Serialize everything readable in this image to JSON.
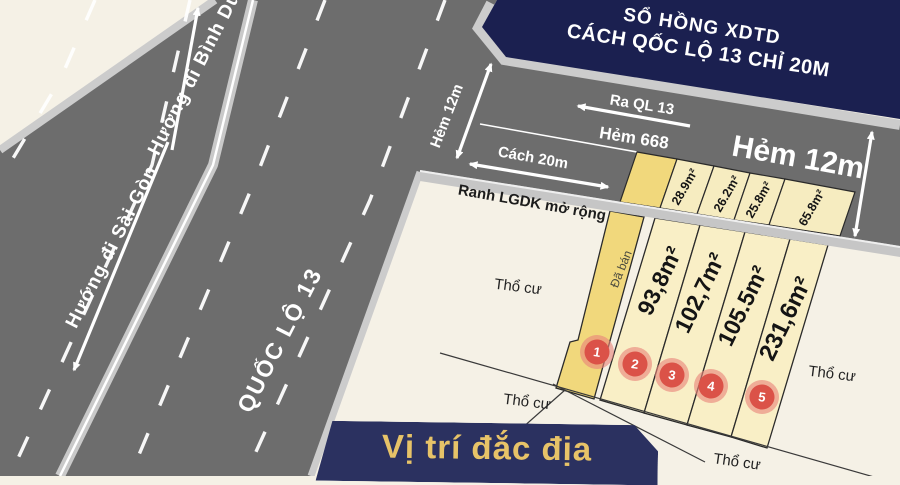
{
  "banner_top": {
    "line1": "SỔ HỒNG XDTD",
    "line2": "CÁCH QỐC LỘ 13 CHỈ 20M"
  },
  "banner_bottom": {
    "text": "Vị trí đắc địa"
  },
  "highway": {
    "name": "QUỐC LỘ 13",
    "dir_saigon": "Hướng đi Sài Gòn",
    "dir_binhduong": "Hướng đi Bình Dương"
  },
  "alley": {
    "name": "Hẻm 668",
    "exit_label": "Ra QL 13",
    "width_label": "Hẻm 12m",
    "distance_label": "Cách 20m",
    "boundary_label": "Ranh LGDK mở rộng"
  },
  "strips": [
    {
      "area": "28.9m²"
    },
    {
      "area": "26.2m²"
    },
    {
      "area": "25.8m²"
    },
    {
      "area": "65.8m²"
    }
  ],
  "plots": [
    {
      "no": "1",
      "status": "Đã bán",
      "area": ""
    },
    {
      "no": "2",
      "area": "93,8m²"
    },
    {
      "no": "3",
      "area": "102,7m²"
    },
    {
      "no": "4",
      "area": "105.5m²"
    },
    {
      "no": "5",
      "area": "231,6m²"
    }
  ],
  "land_use": [
    "Thổ cư",
    "Thổ cư",
    "Thổ cư",
    "Thổ cư"
  ],
  "colors": {
    "navy_top": "#1b2050",
    "navy_bottom": "#2b3160",
    "gold": "#e7c368",
    "road_gray": "#6d6d6d",
    "curb_light": "#cccccc",
    "plot_light": "#f9efc6",
    "plot_dark": "#f1d87c",
    "circle_red": "#db5248",
    "background_cream": "#f5f1e6"
  }
}
